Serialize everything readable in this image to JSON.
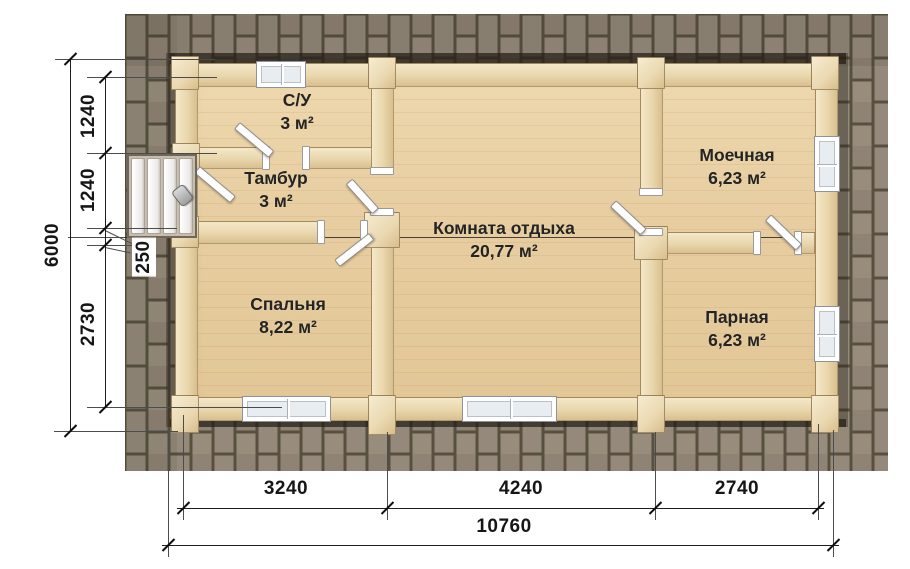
{
  "rooms": [
    {
      "id": "su",
      "name": "С/У",
      "area": "3 м²"
    },
    {
      "id": "tambur",
      "name": "Тамбур",
      "area": "3 м²"
    },
    {
      "id": "moechnaya",
      "name": "Моечная",
      "area": "6,23 м²"
    },
    {
      "id": "komnata",
      "name": "Комната отдыха",
      "area": "20,77 м²"
    },
    {
      "id": "spalnya",
      "name": "Спальня",
      "area": "8,22 м²"
    },
    {
      "id": "parnaya",
      "name": "Парная",
      "area": "6,23 м²"
    }
  ],
  "dimensions": {
    "left_total": "6000",
    "left_segments": [
      "1240",
      "1240",
      "250",
      "2730"
    ],
    "bottom_segments": [
      "3240",
      "4240",
      "2740"
    ],
    "bottom_total": "10760"
  },
  "colors": {
    "roof_joint": "#57503f",
    "roof_shingle": "#93897a",
    "floor_wood": "#e9d2a7",
    "wall_wood": "#eedcb6",
    "dimension_text": "#161616"
  }
}
